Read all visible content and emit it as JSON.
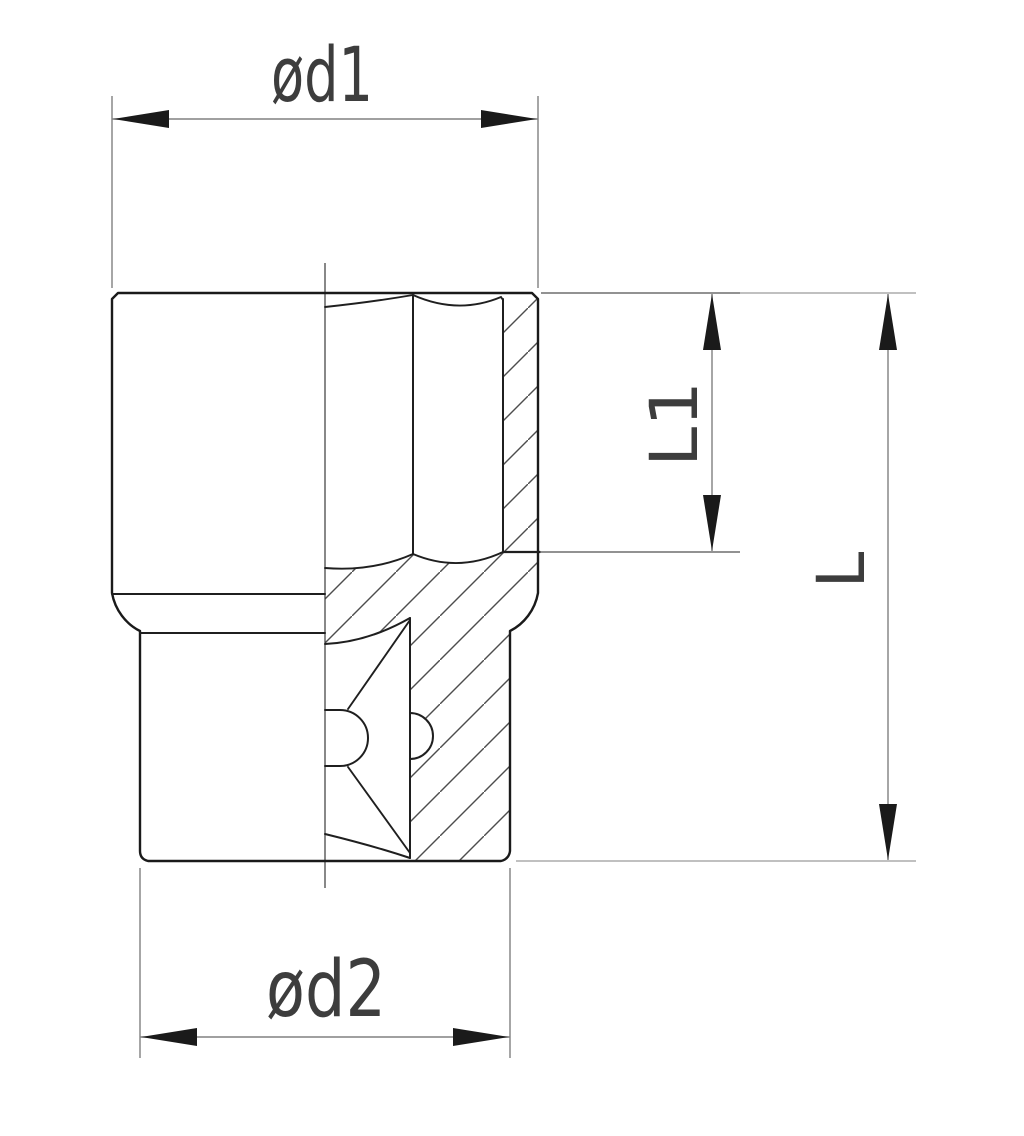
{
  "drawing": {
    "labels": {
      "d1": "ød1",
      "d2": "ød2",
      "l1": "L1",
      "l": "L"
    },
    "colors": {
      "background": "#ffffff",
      "part_outline": "#1a1a1a",
      "dimension_lines": "#808080",
      "hatching": "#4d4d4d",
      "label_text": "#3d3d3d"
    }
  }
}
